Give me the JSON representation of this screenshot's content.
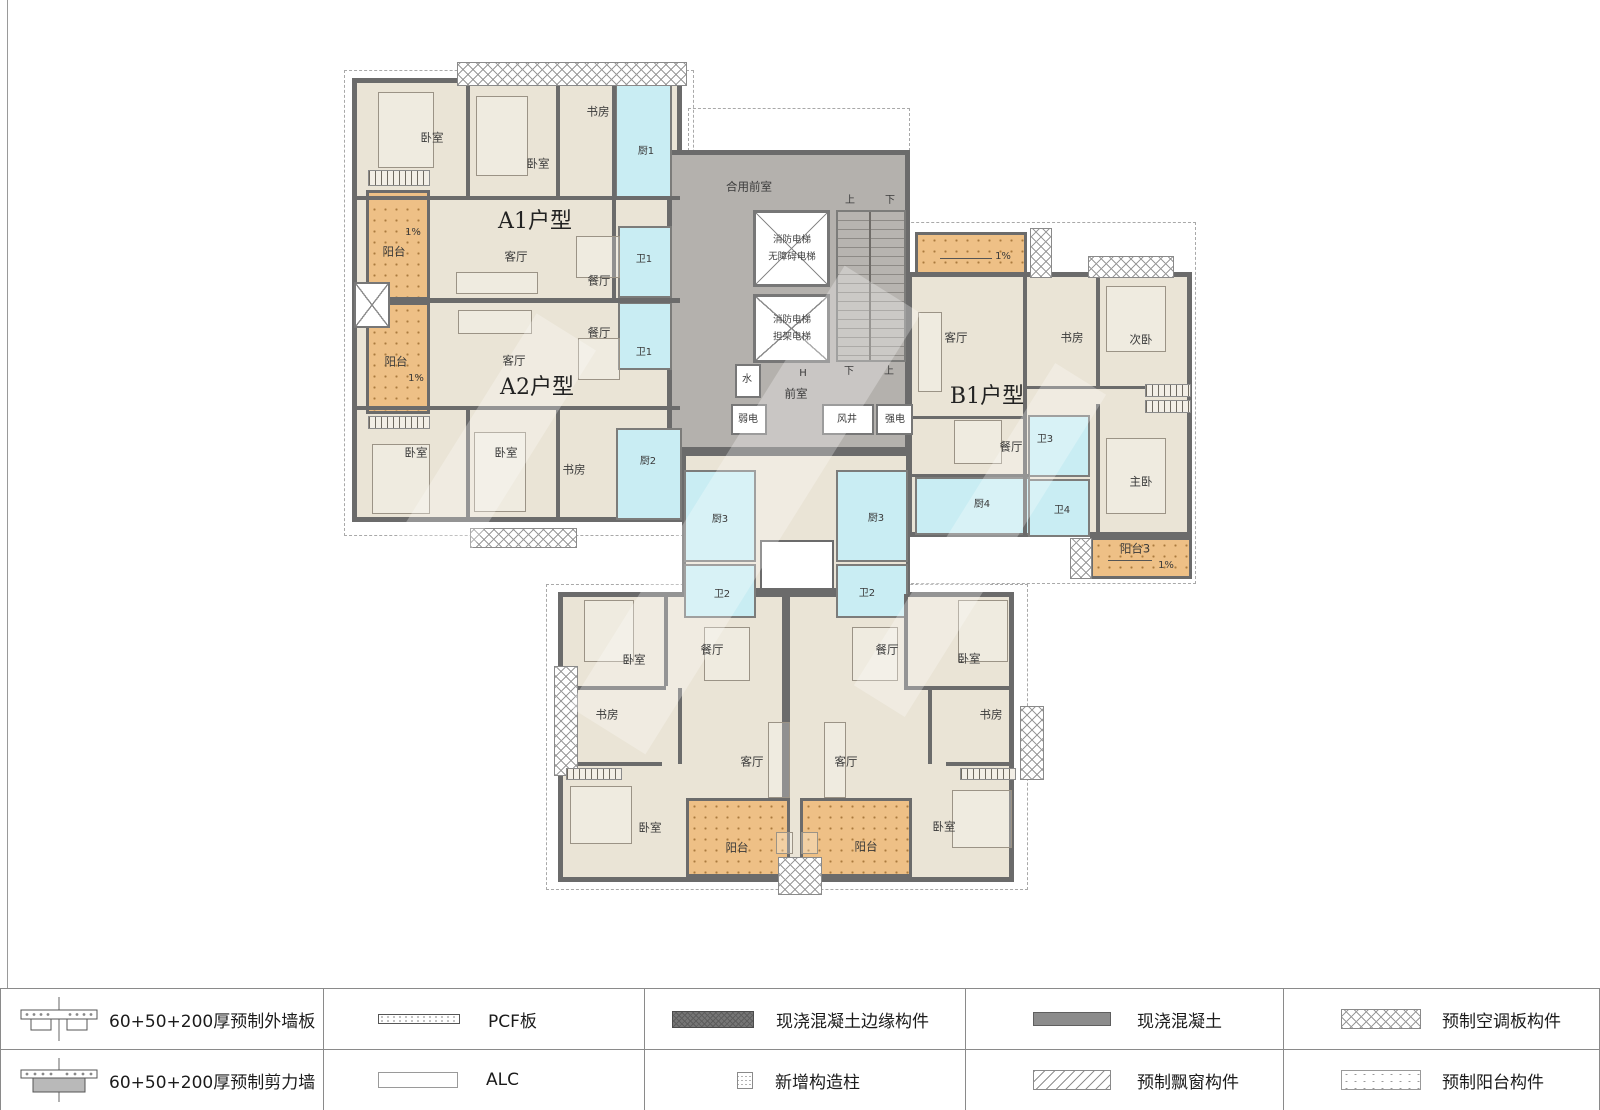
{
  "plan": {
    "unit_titles": {
      "a1": "A1户型",
      "a2": "A2户型",
      "b1": "B1户型"
    },
    "labels": {
      "a1_bed1": "卧室",
      "a1_bed2": "卧室",
      "a1_study": "书房",
      "a1_kitchen": "厨1",
      "a1_balcony": "阳台",
      "a1_slope": "1%",
      "a1_living": "客厅",
      "a1_dining": "餐厅",
      "a1_bath": "卫1",
      "a2_dining": "餐厅",
      "a2_living": "客厅",
      "a2_bath": "卫1",
      "a2_balcony": "阳台",
      "a2_slope": "1%",
      "a2_bed1": "卧室",
      "a2_bed2": "卧室",
      "a2_study": "书房",
      "a2_kitchen": "厨2",
      "b1_living": "客厅",
      "b1_study": "书房",
      "b1_second_bed": "次卧",
      "b1_dining": "餐厅",
      "b1_bath3": "卫3",
      "b1_master_bed": "主卧",
      "b1_kitchen": "厨4",
      "b1_bath4": "卫4",
      "b1_balcony": "阳台3",
      "b1_slope_top": "1%",
      "b1_slope_bottom": "1%",
      "kit3_left": "厨3",
      "kit3_right": "厨3",
      "bath2_left": "卫2",
      "bath2_right": "卫2",
      "bl_bed_top": "卧室",
      "bl_dining": "餐厅",
      "bl_study": "书房",
      "bl_living": "客厅",
      "bl_bed_bottom": "卧室",
      "bl_balcony": "阳台",
      "br_bed_top": "卧室",
      "br_dining": "餐厅",
      "br_study": "书房",
      "br_living": "客厅",
      "br_bed_bottom": "卧室",
      "br_balcony": "阳台"
    },
    "core": {
      "shared_vestibule": "合用前室",
      "lift1_line1": "消防电梯",
      "lift1_line2": "无障碍电梯",
      "lift2_line1": "消防电梯",
      "lift2_line2": "担架电梯",
      "up": "上",
      "down": "下",
      "h_mark": "H",
      "water": "水",
      "vestibule": "前室",
      "weak_power": "弱电",
      "air_shaft": "风井",
      "strong_power": "强电"
    }
  },
  "legend": {
    "rows": [
      [
        {
          "symbol": "exterior-wall-section-icon",
          "label": "60+50+200厚预制外墙板"
        },
        {
          "symbol": "pcf-bar-icon",
          "label": "PCF板"
        },
        {
          "symbol": "edge-member-bar-icon",
          "label": "现浇混凝土边缘构件"
        },
        {
          "symbol": "cast-concrete-bar-icon",
          "label": "现浇混凝土"
        },
        {
          "symbol": "ac-panel-bar-icon",
          "label": "预制空调板构件"
        }
      ],
      [
        {
          "symbol": "shear-wall-section-icon",
          "label": "60+50+200厚预制剪力墙"
        },
        {
          "symbol": "alc-bar-icon",
          "label": "ALC"
        },
        {
          "symbol": "structural-column-icon",
          "label": "新增构造柱"
        },
        {
          "symbol": "bay-window-bar-icon",
          "label": "预制飘窗构件"
        },
        {
          "symbol": "balcony-bar-icon",
          "label": "预制阳台构件"
        }
      ]
    ]
  },
  "colors": {
    "wall": "#6b6b6b",
    "room": "#eae4d6",
    "wet": "#c9edf3",
    "balcony": "#eec086",
    "core": "#b4b1ad"
  }
}
